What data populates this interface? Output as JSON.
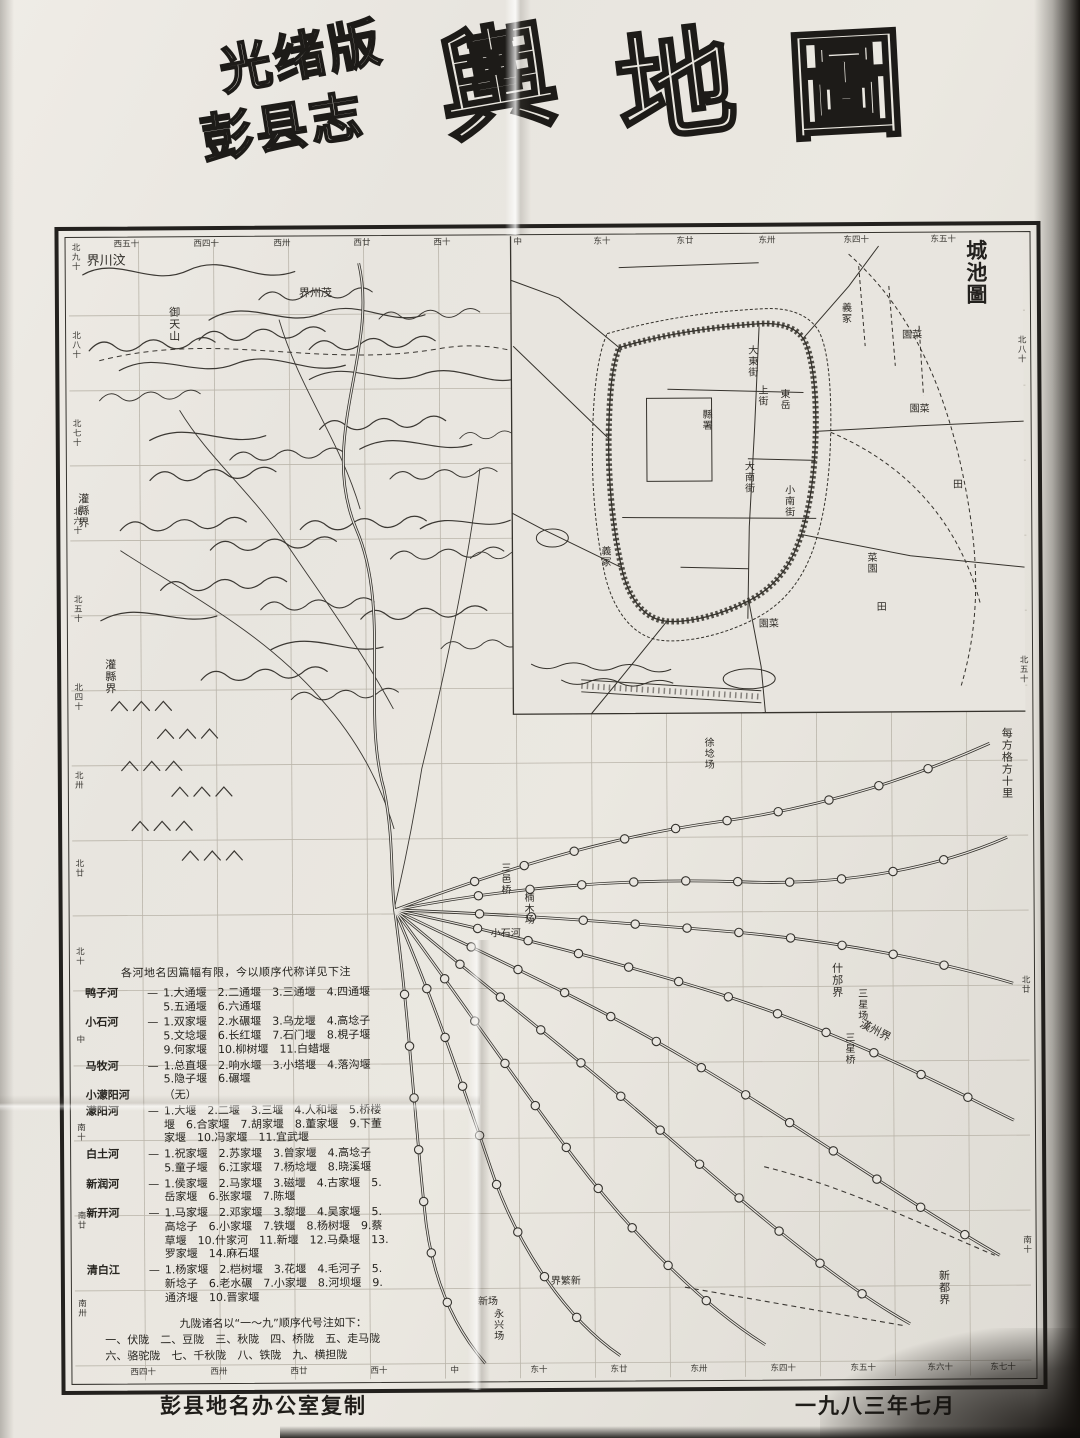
{
  "photo": {
    "paper_color": "#e8e5df",
    "ink_color": "#2a2825",
    "spine_color": "#14110e"
  },
  "title": {
    "edition_line1": "光绪版",
    "edition_line2": "彭县志",
    "main_char1": "輿",
    "main_char2": "地",
    "main_char3": "圖"
  },
  "inset": {
    "title": "城池圖",
    "labels": [
      {
        "text": "縣署"
      },
      {
        "text": "大東街"
      },
      {
        "text": "上街"
      },
      {
        "text": "東岳"
      },
      {
        "text": "大南街"
      },
      {
        "text": "小南街"
      },
      {
        "text": "義冢"
      },
      {
        "text": "園菜"
      },
      {
        "text": "園菜"
      },
      {
        "text": "菜園"
      },
      {
        "text": "義冢"
      },
      {
        "text": "田"
      },
      {
        "text": "田"
      },
      {
        "text": "園菜"
      }
    ]
  },
  "scale_note": "每方格方十里",
  "map_labels": [
    {
      "text": "界川汶"
    },
    {
      "text": "界州茂"
    },
    {
      "text": "灌縣界"
    },
    {
      "text": "灌縣界"
    },
    {
      "text": "御天山"
    },
    {
      "text": "三邑桥"
    },
    {
      "text": "楠木场"
    },
    {
      "text": "小石河"
    },
    {
      "text": "徐埝场"
    },
    {
      "text": "什邡界"
    },
    {
      "text": "三星场"
    },
    {
      "text": "漢州界"
    },
    {
      "text": "三星桥"
    },
    {
      "text": "新都界"
    },
    {
      "text": "界繁新"
    },
    {
      "text": "新场"
    },
    {
      "text": "永兴场"
    }
  ],
  "border_ticks": {
    "top": [
      "西五十",
      "西四十",
      "西卅",
      "西廿",
      "西十",
      "中",
      "东十",
      "东廿",
      "东卅",
      "东四十",
      "东五十"
    ],
    "left": [
      "北九十",
      "北八十",
      "北七十",
      "北六十",
      "北五十",
      "北四十",
      "北卅",
      "北廿",
      "北十",
      "中",
      "南十",
      "南廿",
      "南卅"
    ],
    "bottom": [
      "西四十",
      "西卅",
      "西廿",
      "西十",
      "中",
      "东十",
      "东廿",
      "东卅",
      "东四十",
      "东五十",
      "东六十",
      "东七十"
    ],
    "right": [
      "北八十",
      "北五十",
      "北廿",
      "南十"
    ]
  },
  "legend": {
    "header": "各河地名因篇幅有限，今以顺序代称详见下注",
    "dash": "—",
    "no_dash": "",
    "rivers": [
      {
        "name": "鸭子河",
        "items": "1.大通堰　2.二通堰　3.三通堰　4.四通堰　5.五通堰　6.六通堰"
      },
      {
        "name": "小石河",
        "items": "1.双家堰　2.水碾堰　3.乌龙堰　4.高埝子　5.文埝堰　6.长红堰　7.石门堰　8.梘子堰　9.何家堰　10.柳树堰　11.白蜡堰"
      },
      {
        "name": "马牧河",
        "items": "1.总直堰　2.响水堰　3.小塔堰　4.落沟堰　5.隐子堰　6.碾堰"
      },
      {
        "name": "小濛阳河",
        "items": "（无）"
      },
      {
        "name": "濛阳河",
        "items": "1.大堰　2.二堰　3.三堰　4.人和堰　5.桥楼堰　6.合家堰　7.胡家堰　8.董家堰　9.下董家堰　10.冯家堰　11.宜武堰"
      },
      {
        "name": "白土河",
        "items": "1.祝家堰　2.苏家堰　3.曾家堰　4.高埝子　5.童子堰　6.江家堰　7.杨埝堰　8.晓溪堰"
      },
      {
        "name": "新润河",
        "items": "1.侯家堰　2.马家堰　3.磁堰　4.古家堰　5.岳家堰　6.张家堰　7.陈堰"
      },
      {
        "name": "新开河",
        "items": "1.马家堰　2.邓家堰　3.黎堰　4.吴家堰　5.高埝子　6.小家堰　7.铁堰　8.杨树堰　9.蔡草堰　10.什家河　11.新堰　12.马桑堰　13.罗家堰　14.麻石堰"
      },
      {
        "name": "清白江",
        "items": "1.杨家堰　2.桤树堰　3.花堰　4.毛河子　5.新埝子　6.老水碾　7.小家堰　8.河坝堰　9.通济堰　10.晋家堰"
      }
    ]
  },
  "ridges_note": {
    "header": "九陇诸名以“一～九”顺序代号注如下：",
    "line1": "一、伏陇　二、豆陇　三、秋陇　四、桥陇　五、走马陇",
    "line2": "六、骆驼陇　七、千秋陇　八、铁陇　九、横担陇"
  },
  "footer": {
    "left": "彭县地名办公室复制",
    "right": "一九八三年七月"
  }
}
